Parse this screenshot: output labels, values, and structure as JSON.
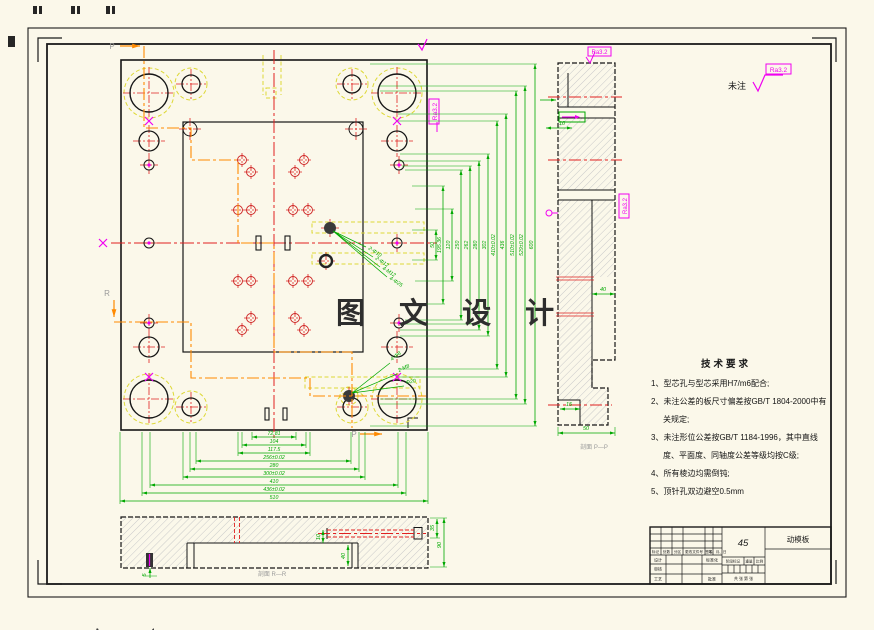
{
  "sheet": {
    "fold_letter": "A",
    "fold_number": "4"
  },
  "watermark": "图 文 设 计",
  "general_note": {
    "prefix": "未注",
    "roughness": "Ra3.2"
  },
  "tech_requirements": {
    "title": "技术要求",
    "items": [
      "1、型芯孔与型芯采用H7/m6配合;",
      "2、未注公差的板尺寸偏差按GB/T 1804-2000中有关规定;",
      "3、未注形位公差按GB/T 1184-1996，其中直线度、平面度、同轴度公差等级均按C级;",
      "4、所有棱边均需倒钝;",
      "5、顶针孔双边避空0.5mm"
    ]
  },
  "main_view": {
    "section_letter_p": "P",
    "section_letter_r": "R",
    "dims_bottom": [
      "72.81",
      "104",
      "117.5",
      "256±0.02",
      "280",
      "300±0.02",
      "410",
      "436±0.02",
      "510"
    ],
    "dims_right": [
      "50",
      "195.36",
      "120",
      "250",
      "262",
      "280",
      "302",
      "410±0.02",
      "436",
      "510±0.02",
      "529±0.02",
      "600"
    ],
    "callouts_center": [
      "2-Φ10",
      "2-Φ12",
      "4-M12",
      "4-Φ25"
    ],
    "callouts_corner": [
      "4-Φ8",
      "2-M8",
      "Φ20"
    ]
  },
  "section_pp": {
    "label": "剖面 P—P",
    "dim_width_top": "10",
    "dim_step": "40",
    "dim_foot": "15",
    "dim_width": "50"
  },
  "section_rr": {
    "label": "剖面 R—R",
    "dim_side_depth": "35",
    "dim_height": "90",
    "dim_pocket_depth": "40",
    "dim_hole": "10",
    "dim_pin": "5"
  },
  "title_block": {
    "part_name": "动模板",
    "material": "45",
    "revision_headers": [
      "标记",
      "处数",
      "分区",
      "更改文件号",
      "签名",
      "年、月、日"
    ],
    "labels": {
      "design": "设计",
      "standardization": "标准化",
      "check": "审核",
      "process": "工艺",
      "approve": "批准",
      "stage": "阶段标记",
      "weight": "重量",
      "scale": "比例",
      "sheets": "共 张 第 张"
    }
  }
}
